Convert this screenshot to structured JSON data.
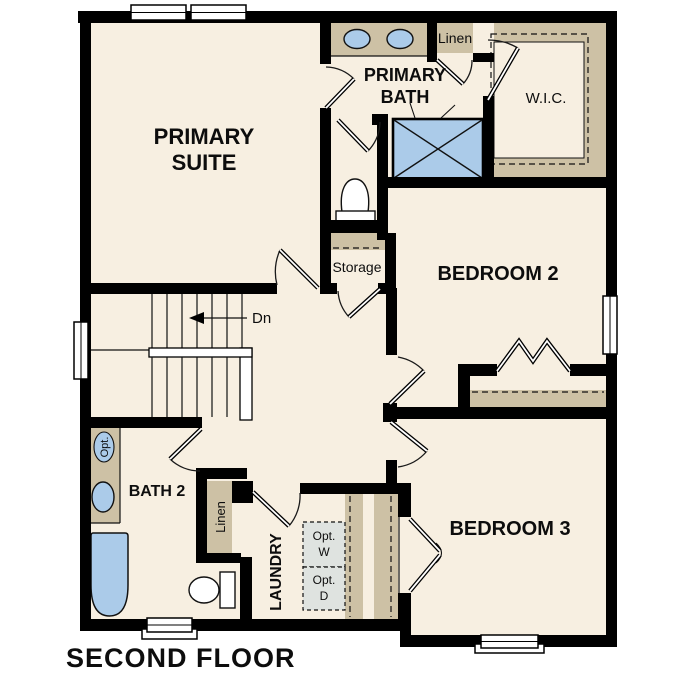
{
  "title": "SECOND FLOOR",
  "colors": {
    "background": "#ffffff",
    "floor": "#f7efe1",
    "wall": "#000000",
    "casework_tan": "#cdc1a5",
    "fixture_blue": "#abcbe9",
    "appliance_gray": "#dfe3e0"
  },
  "rooms": {
    "primary_suite": {
      "line1": "PRIMARY",
      "line2": "SUITE"
    },
    "primary_bath": {
      "line1": "PRIMARY",
      "line2": "BATH"
    },
    "wic": {
      "label": "W.I.C."
    },
    "bedroom_2": {
      "label": "BEDROOM 2"
    },
    "bedroom_3": {
      "label": "BEDROOM 3"
    },
    "bath_2": {
      "label": "BATH 2"
    },
    "laundry": {
      "label": "LAUNDRY"
    },
    "storage": {
      "label": "Storage"
    },
    "linen_primary": {
      "label": "Linen"
    },
    "linen_hall": {
      "label": "Linen"
    }
  },
  "annotations": {
    "stair_direction": "Dn",
    "optional_sink": "Opt.",
    "optional_washer": {
      "line1": "Opt.",
      "line2": "W"
    },
    "optional_dryer": {
      "line1": "Opt.",
      "line2": "D"
    }
  }
}
